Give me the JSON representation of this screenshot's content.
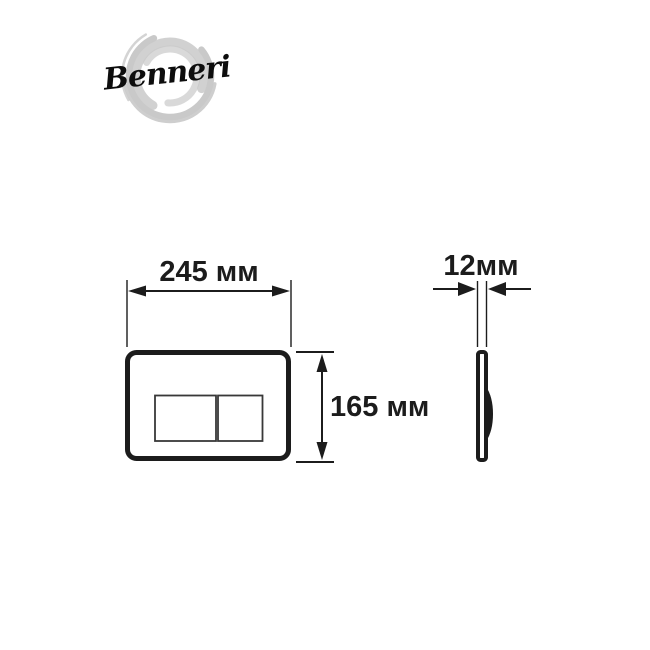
{
  "logo": {
    "brand": "Benneri",
    "brush_color": "#c9c9c9",
    "text_color": "#0d0d0d"
  },
  "diagram": {
    "subject": "toilet-flush-plate-dimension-drawing",
    "front_view": {
      "width_label": "245 мм",
      "height_label": "165 мм"
    },
    "side_view": {
      "depth_label": "12мм"
    },
    "line_color": "#1c1c1c",
    "background_color": "#ffffff"
  }
}
